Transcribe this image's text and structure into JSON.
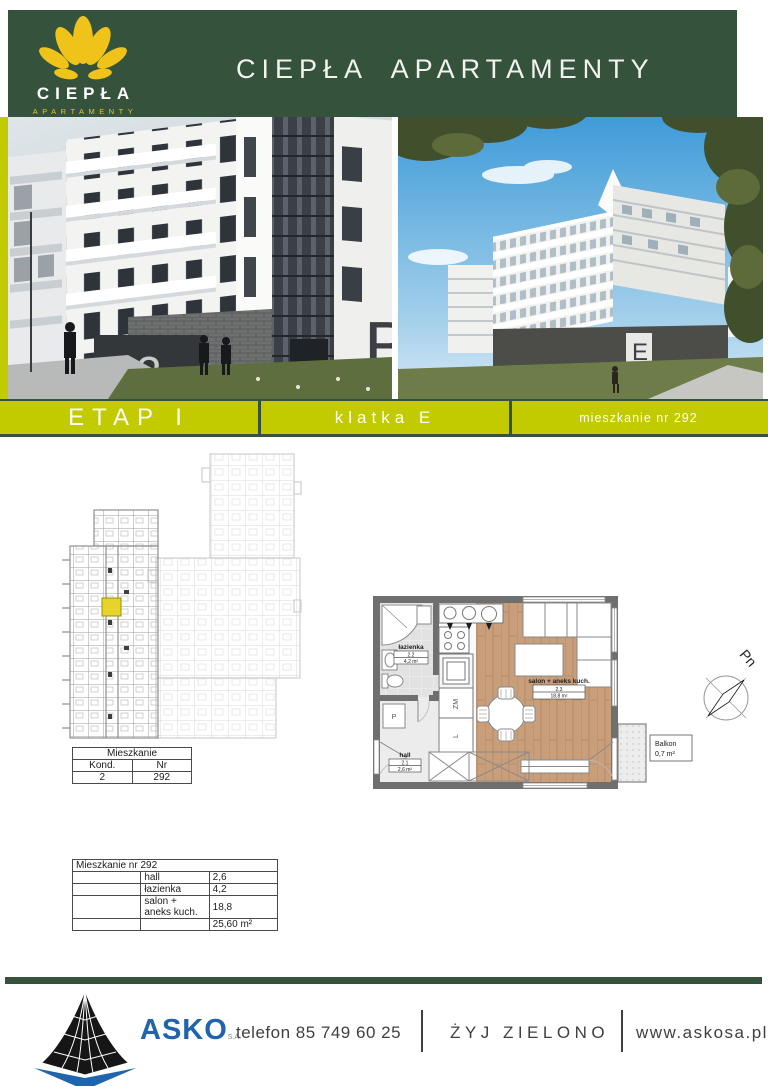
{
  "colors": {
    "header_green": "#35533C",
    "bar_yellow": "#C2CB00",
    "logo_gold": "#EFC31A",
    "asko_blue": "#1F64AD",
    "highlight_unit_yellow": "#E6D32B"
  },
  "header": {
    "logo_name": "CIEPŁA",
    "logo_subtitle": "APARTAMENTY",
    "title": "CIEPŁA APARTAMENTY"
  },
  "banner": {
    "etap": "ETAP I",
    "klatka": "klatka E",
    "mieszkanie": "mieszkanie nr 292"
  },
  "photos": {
    "left_building_letter": "B",
    "left_storefront_number": "2",
    "right_building_letter": "E"
  },
  "location_table": {
    "title": "Mieszkanie",
    "col_kond": "Kond.",
    "col_nr": "Nr",
    "kond": "2",
    "nr": "292"
  },
  "details_table": {
    "title": "Mieszkanie nr 292",
    "rows": [
      {
        "name": "hall",
        "value": "2,6"
      },
      {
        "name": "łazienka",
        "value": "4,2"
      },
      {
        "name": "salon + aneks kuch.",
        "value": "18,8"
      }
    ],
    "total": "25,60 m²"
  },
  "floor_plan": {
    "lazienka_label": "łazienka",
    "lazienka_no": "2.2",
    "lazienka_area": "4,2 m²",
    "hall_label": "hall",
    "hall_no": "2.1",
    "hall_area": "2,6 m²",
    "salon_label": "salon + aneks kuch.",
    "salon_no": "2.3",
    "salon_area": "18,8 m²",
    "balkon_label": "Balkon",
    "balkon_area": "0,7 m²",
    "dishwasher": "ZM",
    "fridge": "L",
    "washer": "P"
  },
  "compass": {
    "north": "Pn"
  },
  "footer": {
    "brand": "ASKO",
    "brand_suffix": "S.A.",
    "phone": "telefon 85 749 60 25",
    "slogan": "ŻYJ ZIELONO",
    "website": "www.askosa.pl"
  }
}
